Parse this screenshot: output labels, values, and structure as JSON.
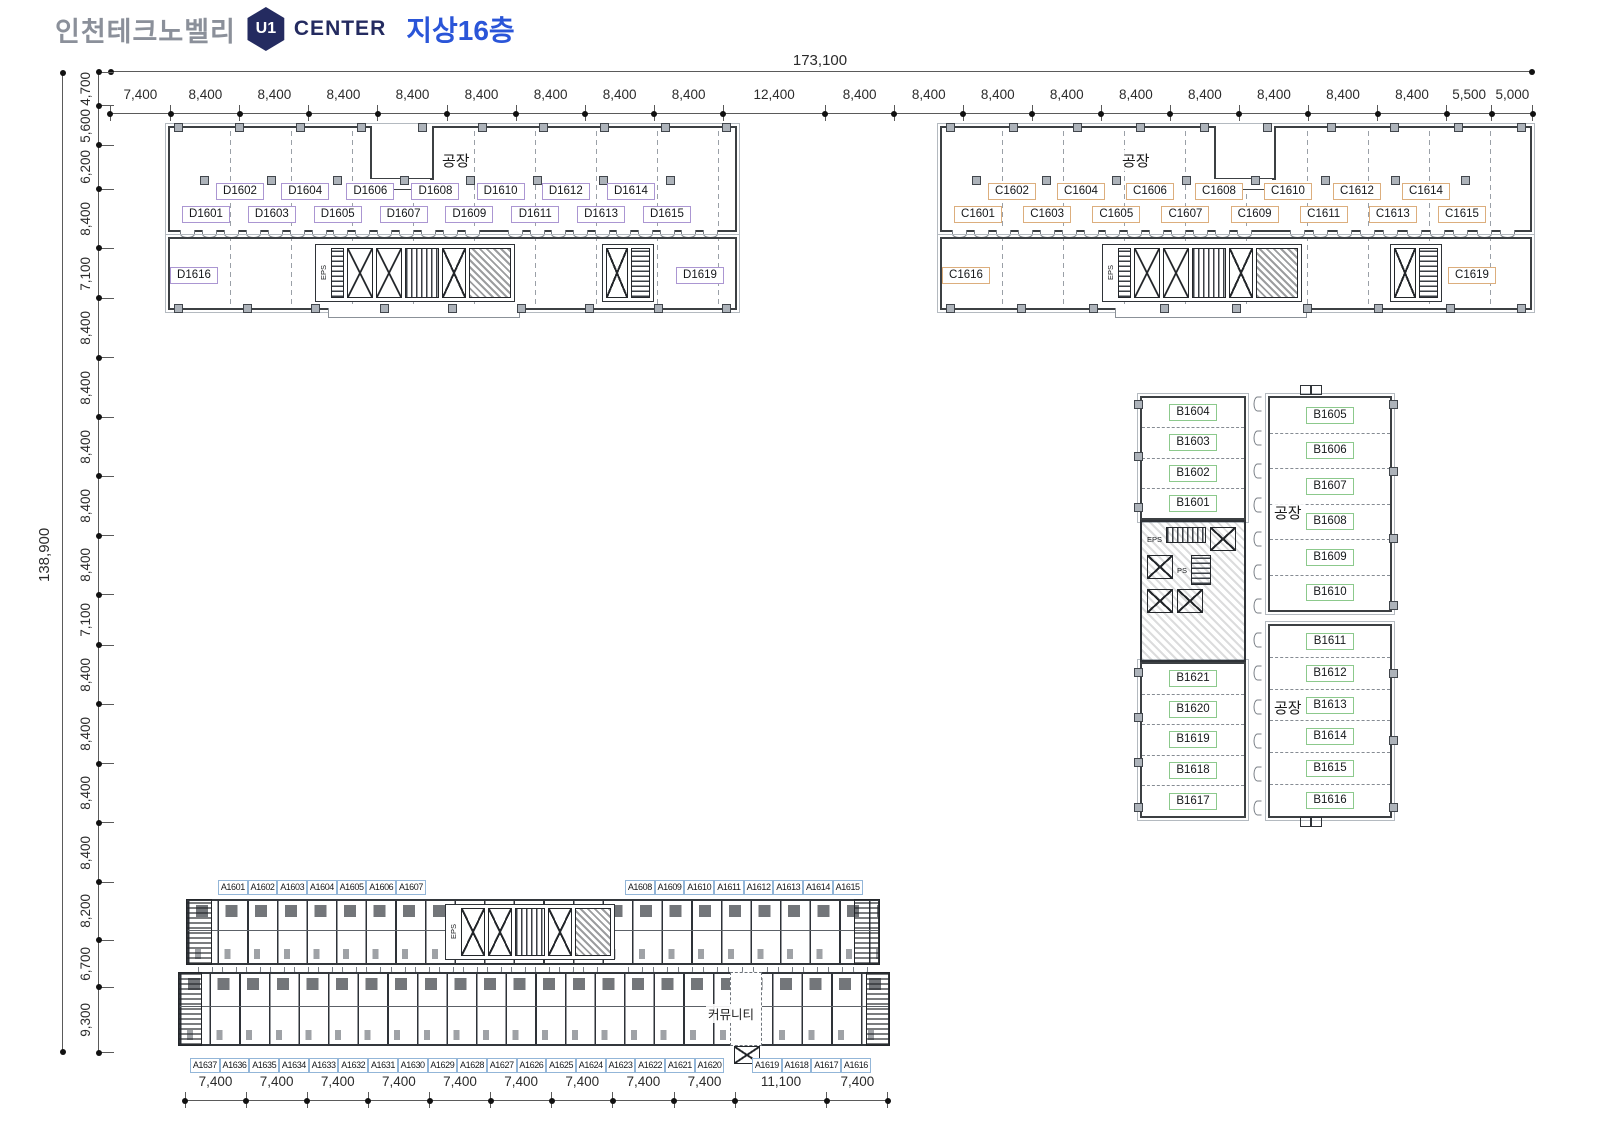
{
  "header": {
    "brand": "인천테크노벨리",
    "logo_text": "U1",
    "center": "CENTER",
    "floor": "지상16층",
    "colors": {
      "brand": "#8b909a",
      "navy": "#242b60",
      "blue": "#2a55d8"
    }
  },
  "factory_label": "공장",
  "community_label": "커뮤니티",
  "core_labels": {
    "eps": "EPS",
    "ps": "PS"
  },
  "dims": {
    "top_total": "173,100",
    "left_total": "138,900",
    "top_segments": [
      "7,400",
      "8,400",
      "8,400",
      "8,400",
      "8,400",
      "8,400",
      "8,400",
      "8,400",
      "8,400",
      "12,400",
      "8,400",
      "8,400",
      "8,400",
      "8,400",
      "8,400",
      "8,400",
      "8,400",
      "8,400",
      "8,400",
      "5,500",
      "5,000"
    ],
    "left_segments": [
      "4,700",
      "5,600",
      "6,200",
      "8,400",
      "7,100",
      "8,400",
      "8,400",
      "8,400",
      "8,400",
      "8,400",
      "7,100",
      "8,400",
      "8,400",
      "8,400",
      "8,400",
      "8,200",
      "6,700",
      "9,300"
    ],
    "bottom_segments": [
      "7,400",
      "7,400",
      "7,400",
      "7,400",
      "7,400",
      "7,400",
      "7,400",
      "7,400",
      "7,400",
      "11,100",
      "7,400"
    ]
  },
  "blocks": {
    "d": {
      "accent": "#ab96d2",
      "upper_row": [
        "D1602",
        "D1604",
        "D1606",
        "D1608",
        "D1610",
        "D1612",
        "D1614"
      ],
      "lower_row": [
        "D1601",
        "D1603",
        "D1605",
        "D1607",
        "D1609",
        "D1611",
        "D1613",
        "D1615"
      ],
      "south_rooms": [
        "D1619",
        "D1618",
        "D1617",
        "D1616"
      ]
    },
    "c": {
      "accent": "#dcae7d",
      "upper_row": [
        "C1602",
        "C1604",
        "C1606",
        "C1608",
        "C1610",
        "C1612",
        "C1614"
      ],
      "lower_row": [
        "C1601",
        "C1603",
        "C1605",
        "C1607",
        "C1609",
        "C1611",
        "C1613",
        "C1615"
      ],
      "south_rooms": [
        "C1619",
        "C1618",
        "C1617",
        "C1616"
      ]
    },
    "b": {
      "accent": "#8cc98c",
      "west_upper": [
        "B1604",
        "B1603",
        "B1602",
        "B1601"
      ],
      "east_upper": [
        "B1605",
        "B1606",
        "B1607",
        "B1608",
        "B1609",
        "B1610"
      ],
      "west_lower": [
        "B1621",
        "B1620",
        "B1619",
        "B1618",
        "B1617"
      ],
      "east_lower": [
        "B1611",
        "B1612",
        "B1613",
        "B1614",
        "B1615",
        "B1616"
      ]
    },
    "a": {
      "accent": "#93b6d8",
      "north_left": [
        "A1601",
        "A1602",
        "A1603",
        "A1604",
        "A1605",
        "A1606",
        "A1607"
      ],
      "north_right": [
        "A1608",
        "A1609",
        "A1610",
        "A1611",
        "A1612",
        "A1613",
        "A1614",
        "A1615"
      ],
      "south_left": [
        "A1637",
        "A1636",
        "A1635",
        "A1634",
        "A1633",
        "A1632",
        "A1631",
        "A1630",
        "A1629",
        "A1628",
        "A1627",
        "A1626",
        "A1625",
        "A1624",
        "A1623",
        "A1622",
        "A1621",
        "A1620"
      ],
      "south_right": [
        "A1619",
        "A1618",
        "A1617",
        "A1616"
      ]
    }
  }
}
